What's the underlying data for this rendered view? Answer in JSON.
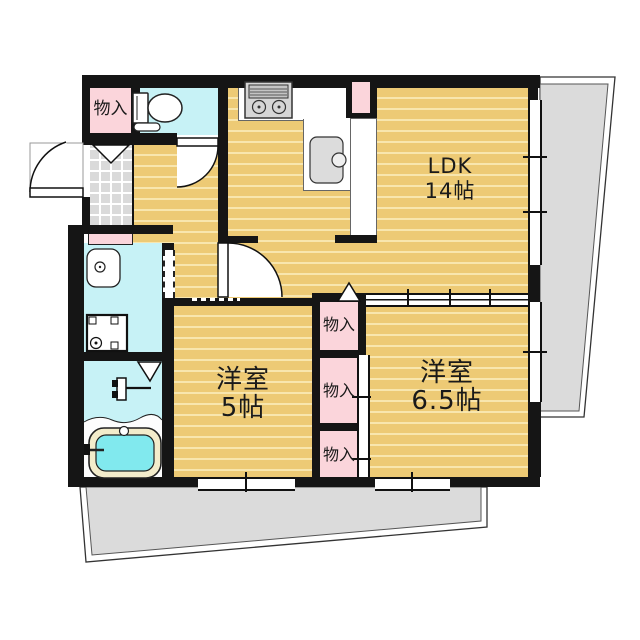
{
  "floorplan": {
    "type": "apartment-floor-plan",
    "rooms": {
      "ldk": {
        "label": "LDK",
        "size": "14帖"
      },
      "bedroom_5": {
        "label": "洋室",
        "size": "5帖"
      },
      "bedroom_65": {
        "label": "洋室",
        "size": "6.5帖"
      }
    },
    "storage": {
      "entry_label": "物入",
      "upper_label": "物入",
      "middle_label": "物入",
      "lower_label": "物入"
    },
    "fixtures": [
      "toilet",
      "kitchen-stove",
      "kitchen-sink",
      "washbasin",
      "washing-machine-pan",
      "bathtub",
      "bath-faucet",
      "entrance-door",
      "toilet-door",
      "ldk-door",
      "balcony-right",
      "balcony-bottom"
    ],
    "colors": {
      "wall": "#151515",
      "wood_floor": "#EDCA75",
      "floor_stripe": "#F8E6AE",
      "storage_pink": "#FBD5DB",
      "wet_area_cyan": "#C7F2F6",
      "bath_water": "#81E9EE",
      "tub_rim": "#F3ECCB",
      "balcony_gray": "#DBDBDB",
      "entry_tile_gray": "#DADADA"
    }
  }
}
